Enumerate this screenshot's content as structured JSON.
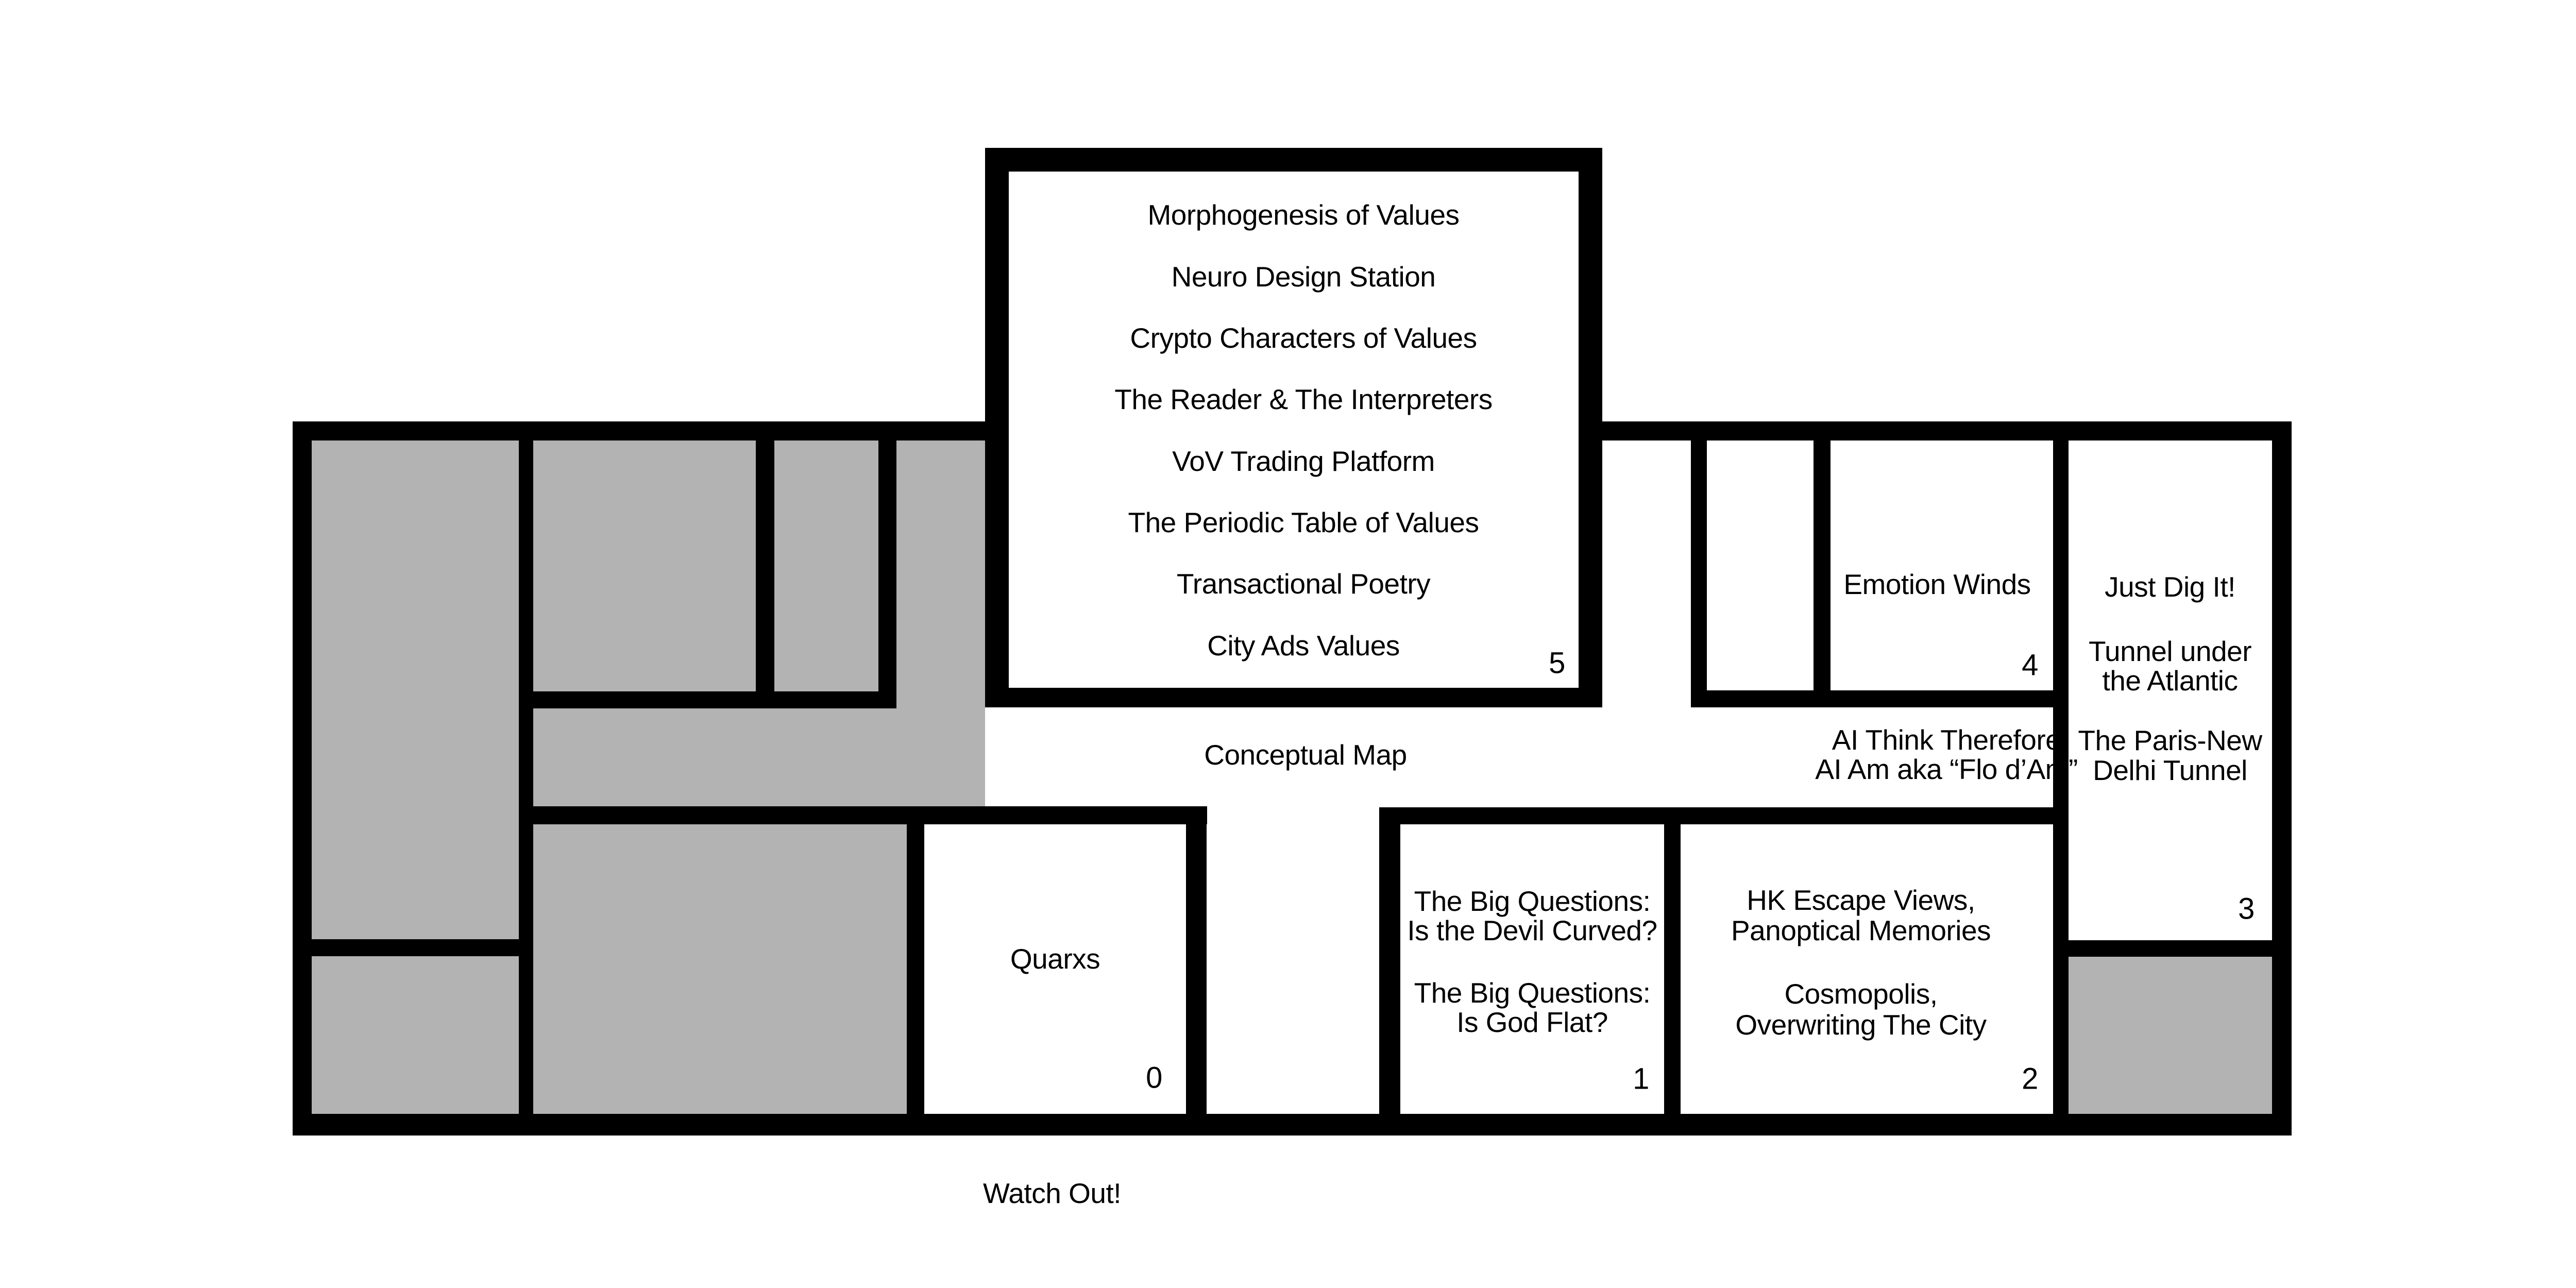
{
  "colors": {
    "wall": "#000000",
    "gray": "#b3b3b3",
    "background": "#ffffff",
    "text": "#000000"
  },
  "rooms": {
    "room5": {
      "number": "5",
      "items": [
        "Morphogenesis of Values",
        "Neuro Design Station",
        "Crypto Characters of Values",
        "The Reader & The Interpreters",
        "VoV Trading Platform",
        "The Periodic Table of Values",
        "Transactional Poetry",
        "City Ads Values"
      ]
    },
    "room4": {
      "number": "4",
      "label": "Emotion Winds"
    },
    "room3": {
      "number": "3",
      "lines": [
        "Just Dig It!",
        "Tunnel under",
        "the Atlantic",
        "The Paris-New",
        "Delhi Tunnel"
      ]
    },
    "room0": {
      "number": "0",
      "label": "Quarxs"
    },
    "room1": {
      "number": "1",
      "lines": [
        "The Big Questions:",
        "Is the Devil Curved?",
        "The Big Questions:",
        "Is God Flat?"
      ]
    },
    "room2": {
      "number": "2",
      "lines": [
        "HK Escape Views,",
        "Panoptical Memories",
        "Cosmopolis,",
        "Overwriting The City"
      ]
    }
  },
  "corridor": {
    "map_label": "Conceptual Map",
    "ai_line1": "AI Think Therefore",
    "ai_line2": "AI Am aka “Flo d’Am”"
  },
  "outside": {
    "warning": "Watch Out!"
  }
}
